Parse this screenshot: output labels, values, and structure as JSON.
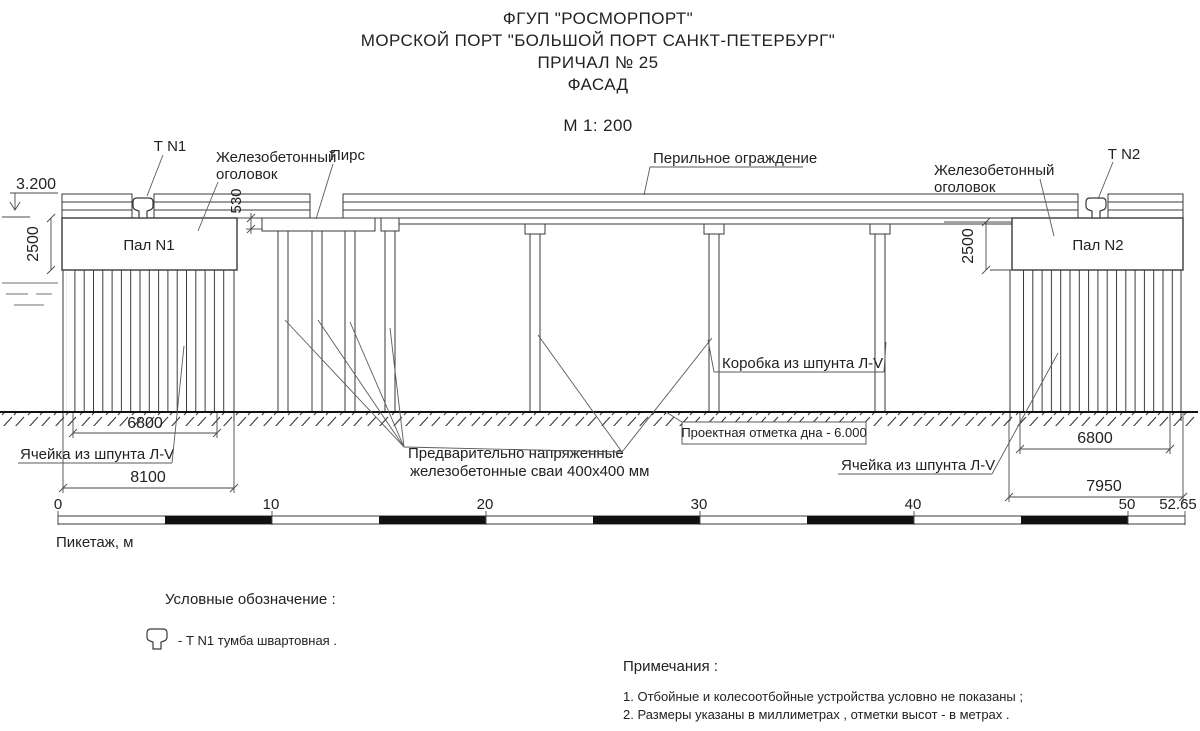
{
  "title": {
    "line1": "ФГУП \"РОСМОРПОРТ\"",
    "line2": "МОРСКОЙ ПОРТ \"БОЛЬШОЙ ПОРТ САНКТ-ПЕТЕРБУРГ\"",
    "line3": "ПРИЧАЛ № 25",
    "line4": "ФАСАД",
    "scale": "М 1: 200"
  },
  "labels": {
    "t_n1": "Т N1",
    "t_n2": "Т N2",
    "cap_left_line1": "Железобетонный",
    "cap_left_line2": "оголовок",
    "cap_right_line1": "Железобетонный",
    "cap_right_line2": "оголовок",
    "pier": "Пирс",
    "railing": "Перильное ограждение",
    "pal1": "Пал N1",
    "pal2": "Пал N2",
    "sheet_box": "Коробка из шпунта Л-V",
    "project_bottom": "Проектная отметка дна - 6.000",
    "cell_left": "Ячейка из шпунта Л-V",
    "cell_right": "Ячейка из шпунта Л-V",
    "piles_line1": "Предварительно напряженные",
    "piles_line2": "железобетонные сваи 400х400 мм"
  },
  "dimensions": {
    "elevation": "3.200",
    "step": "530",
    "pal1_height": "2500",
    "pal2_height": "2500",
    "cell1_inner": "6800",
    "cell1_outer": "8100",
    "cell2_inner": "6800",
    "cell2_outer": "7950"
  },
  "scale_bar": {
    "ticks": [
      "0",
      "10",
      "20",
      "30",
      "40",
      "50"
    ],
    "end": "52.65",
    "unit_label": "Пикетаж, м"
  },
  "legend": {
    "heading": "Условные обозначение :",
    "bollard_label": "- Т N1 тумба швартовная ."
  },
  "notes": {
    "heading": "Примечания :",
    "items": [
      "1. Отбойные и колесоотбойные устройства условно не показаны ;",
      "2. Размеры указаны в миллиметрах , отметки высот - в метрах ."
    ]
  },
  "colors": {
    "ink": "#222222",
    "line": "#3a3a3a",
    "ground": "#111111",
    "bar_black": "#111111",
    "water": "#8a8a8a",
    "background": "#ffffff"
  }
}
